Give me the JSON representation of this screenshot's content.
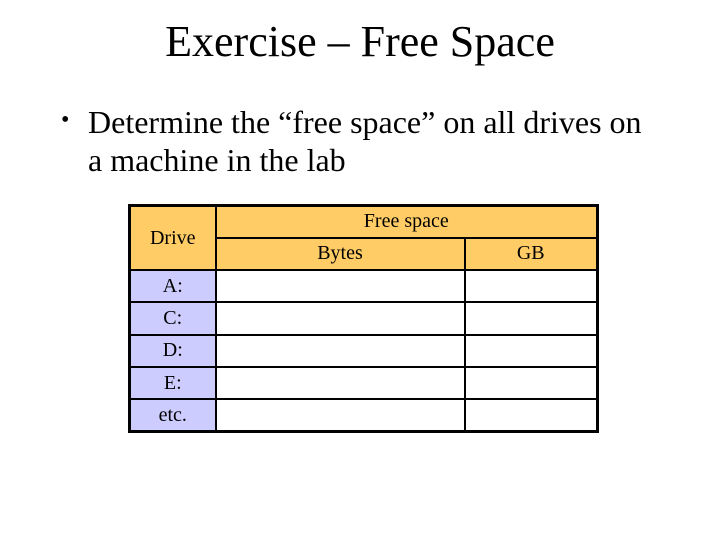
{
  "slide": {
    "title": "Exercise – Free Space",
    "bullet_glyph": "•",
    "bullet_text": "Determine the “free space” on all drives on a machine in the lab"
  },
  "table": {
    "header": {
      "drive": "Drive",
      "free_space": "Free space",
      "bytes": "Bytes",
      "gb": "GB"
    },
    "rows": [
      {
        "label": "A:",
        "bytes": "",
        "gb": ""
      },
      {
        "label": "C:",
        "bytes": "",
        "gb": ""
      },
      {
        "label": "D:",
        "bytes": "",
        "gb": ""
      },
      {
        "label": "E:",
        "bytes": "",
        "gb": ""
      },
      {
        "label": "etc.",
        "bytes": "",
        "gb": ""
      }
    ],
    "colors": {
      "header_bg": "#FFCC66",
      "row_label_bg": "#CCCCFF",
      "cell_bg": "#FFFFFF",
      "border": "#000000"
    }
  }
}
